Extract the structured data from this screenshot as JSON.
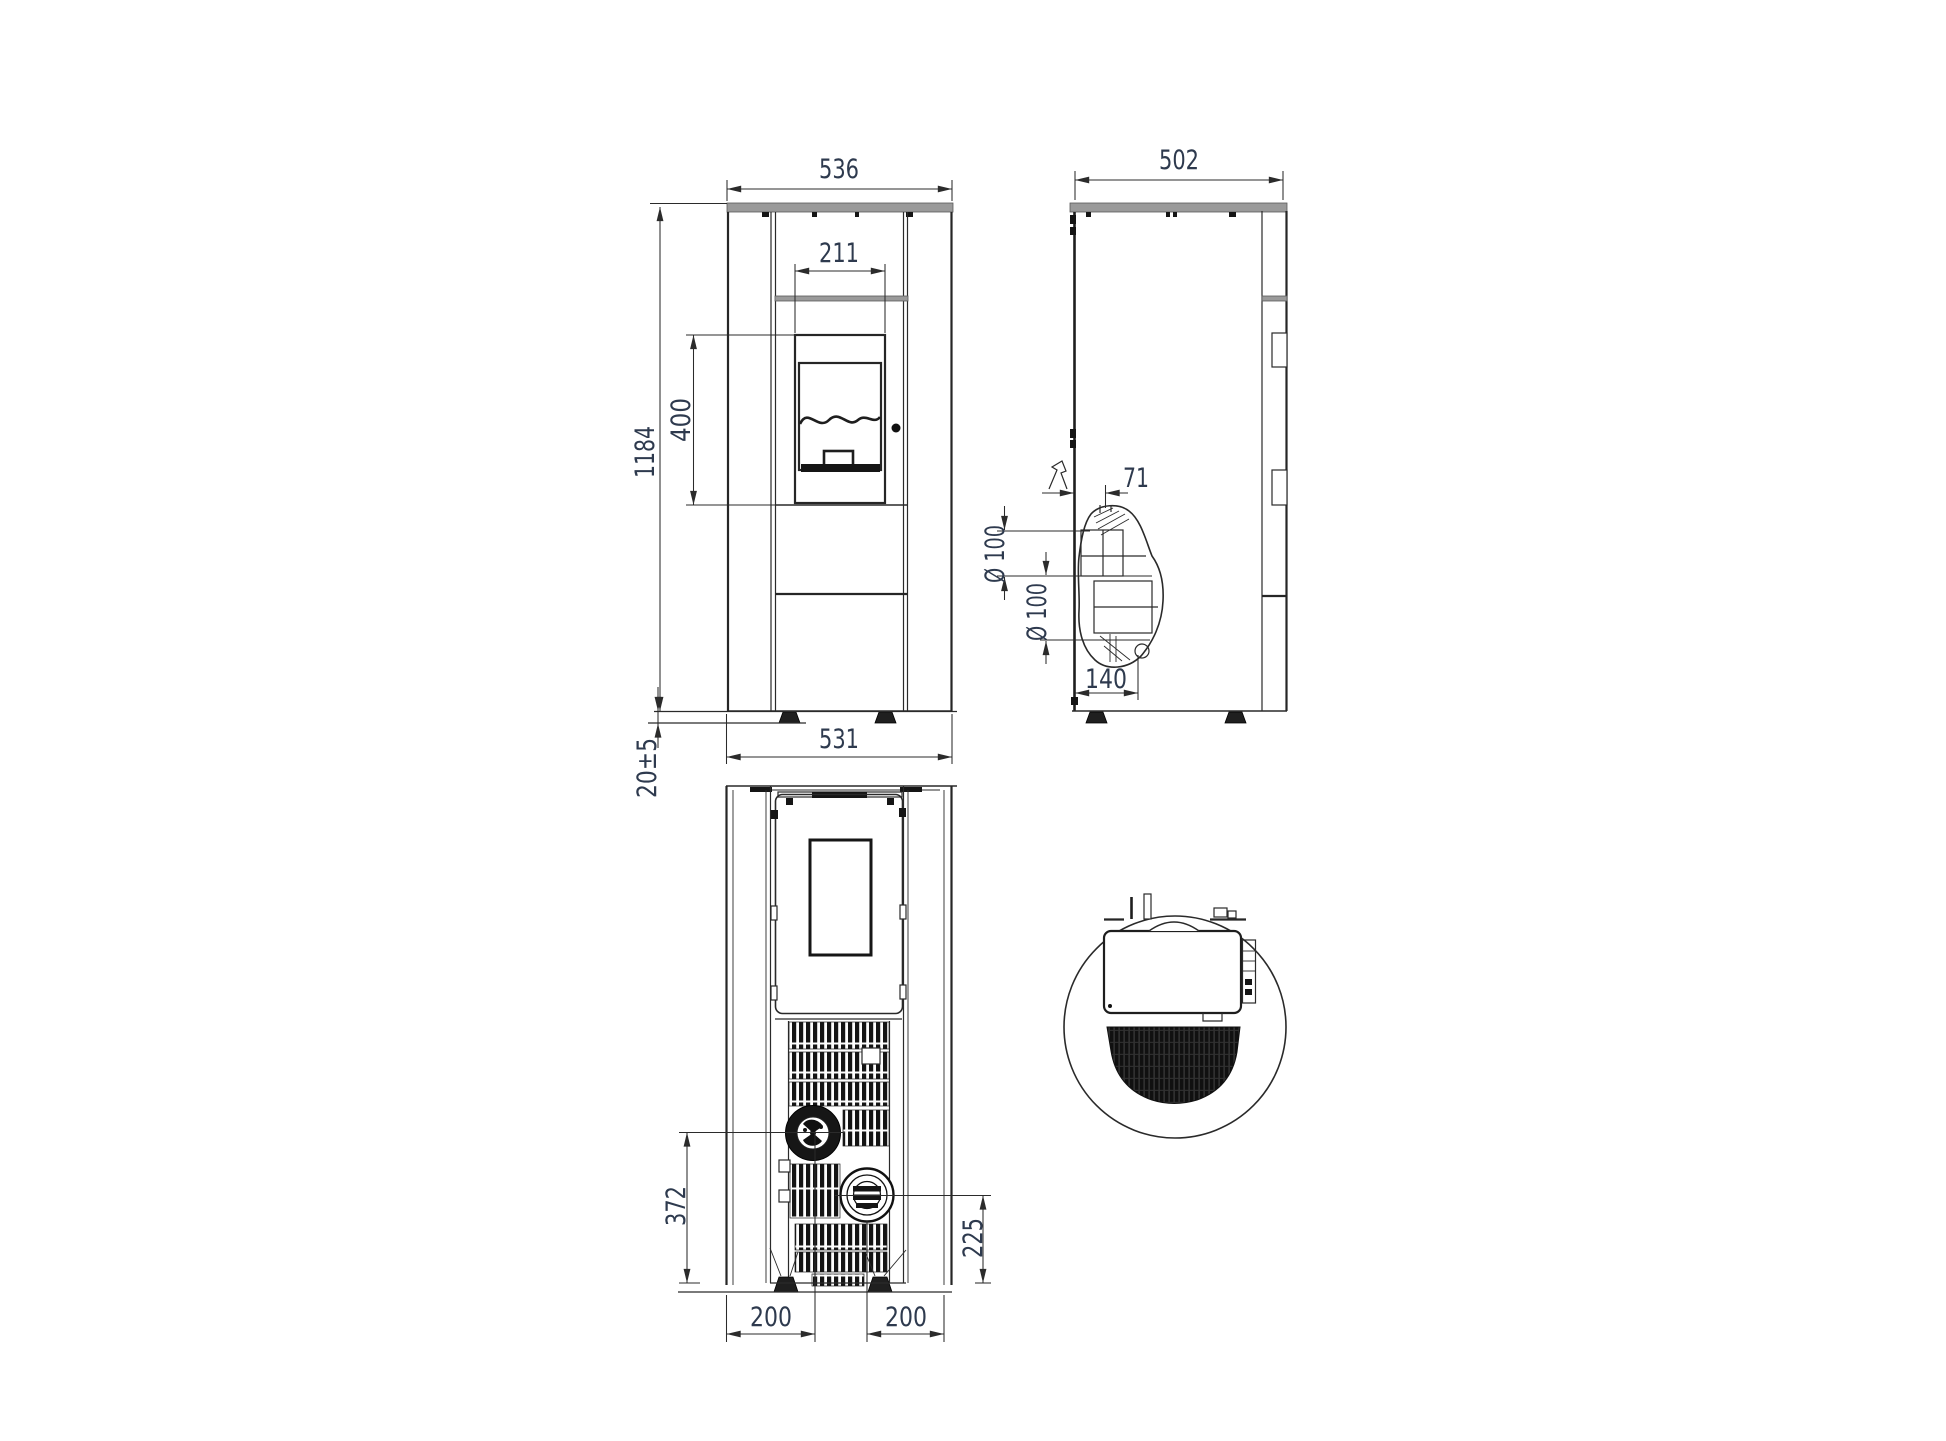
{
  "palette": {
    "background": "#ffffff",
    "line": "#2a2a2a",
    "dim_text": "#2e3a4e",
    "plate_gray": "#9a9a9a"
  },
  "drawing": {
    "views": {
      "front": {
        "dims": {
          "top_width": "536",
          "window_width": "211",
          "window_height": "400",
          "body_height": "1184",
          "foot_height": "20±5",
          "bottom_width": "531"
        }
      },
      "side": {
        "dims": {
          "depth": "502",
          "flue_offset": "71",
          "pipe_top_diameter": "Ø 100",
          "pipe_rear_diameter": "Ø 100",
          "flue_depth": "140"
        }
      },
      "bottom": {
        "dims": {
          "air_inlet_height": "372",
          "flue_outlet_height": "225",
          "left_offset": "200",
          "right_offset": "200"
        }
      }
    }
  }
}
